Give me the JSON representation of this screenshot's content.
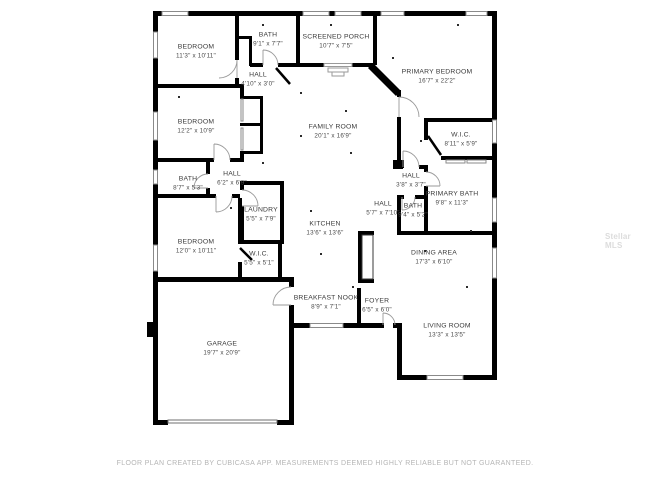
{
  "title": "Floor plan",
  "watermark": "Stellar MLS",
  "footer": "FLOOR PLAN CREATED BY CUBICASA APP. MEASUREMENTS DEEMED HIGHLY RELIABLE BUT NOT GUARANTEED.",
  "colors": {
    "wall": "#000000",
    "label": "#3b3b3b",
    "window_stroke": "#8a8a8a",
    "door_arc": "#9a9a9a",
    "footer_text": "#b5b5b5",
    "watermark_text": "#dcdcdc",
    "background": "#ffffff"
  },
  "rooms": [
    {
      "id": "bedroom-top-left",
      "name": "BEDROOM",
      "dims": "11'3\" x 10'11\""
    },
    {
      "id": "bath-top",
      "name": "BATH",
      "dims": "9'1\" x 7'7\""
    },
    {
      "id": "screened-porch",
      "name": "SCREENED PORCH",
      "dims": "10'7\" x 7'5\""
    },
    {
      "id": "hall-north",
      "name": "HALL",
      "dims": "4'10\" x 3'0\""
    },
    {
      "id": "primary-bedroom",
      "name": "PRIMARY BEDROOM",
      "dims": "16'7\" x 22'2\""
    },
    {
      "id": "bedroom-mid-left",
      "name": "BEDROOM",
      "dims": "12'2\" x 10'9\""
    },
    {
      "id": "family-room",
      "name": "FAMILY ROOM",
      "dims": "20'1\" x 16'9\""
    },
    {
      "id": "wic-primary",
      "name": "W.I.C.",
      "dims": "8'11\" x 5'9\""
    },
    {
      "id": "bath-mid-left",
      "name": "BATH",
      "dims": "8'7\" x 5'3\""
    },
    {
      "id": "hall-mid-left",
      "name": "HALL",
      "dims": "6'2\" x 6'9\""
    },
    {
      "id": "hall-primary",
      "name": "HALL",
      "dims": "3'8\" x 3'7\""
    },
    {
      "id": "primary-bath",
      "name": "PRIMARY BATH",
      "dims": "9'8\" x 11'3\""
    },
    {
      "id": "laundry",
      "name": "LAUNDRY",
      "dims": "5'5\" x 7'9\""
    },
    {
      "id": "hall-kitchen",
      "name": "HALL",
      "dims": "5'7\" x 7'10\""
    },
    {
      "id": "bath-hall",
      "name": "BATH",
      "dims": "9'4\" x 5'2\""
    },
    {
      "id": "bedroom-bottom-left",
      "name": "BEDROOM",
      "dims": "12'0\" x 10'11\""
    },
    {
      "id": "wic-bedroom",
      "name": "W.I.C.",
      "dims": "5'5\" x 5'1\""
    },
    {
      "id": "kitchen",
      "name": "KITCHEN",
      "dims": "13'6\" x 13'6\""
    },
    {
      "id": "dining-area",
      "name": "DINING AREA",
      "dims": "17'3\" x 6'10\""
    },
    {
      "id": "breakfast-nook",
      "name": "BREAKFAST NOOK",
      "dims": "8'9\" x 7'1\""
    },
    {
      "id": "foyer",
      "name": "FOYER",
      "dims": "6'5\" x 6'0\""
    },
    {
      "id": "living-room",
      "name": "LIVING ROOM",
      "dims": "13'3\" x 13'5\""
    },
    {
      "id": "garage",
      "name": "GARAGE",
      "dims": "19'7\" x 20'9\""
    }
  ]
}
